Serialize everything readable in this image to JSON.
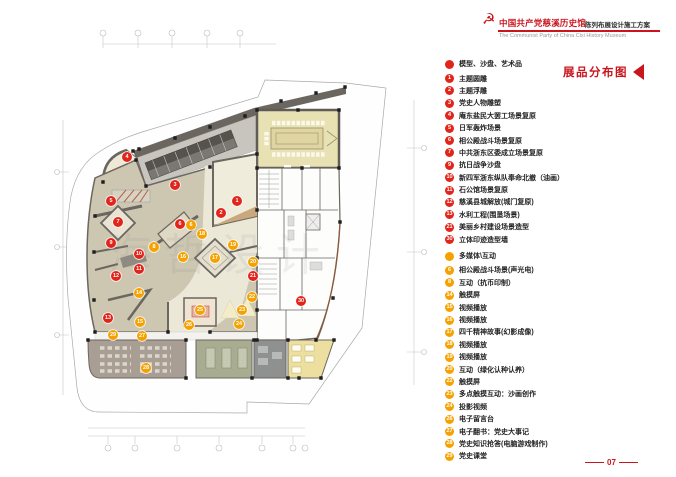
{
  "header": {
    "emblem_icon": "party-emblem",
    "title": "中国共产党慈溪历史馆",
    "subtitle": "陈列布展设计施工方案",
    "title_en": "The Communist Party of China Cixi  History Museum",
    "accent_color": "#c9161d"
  },
  "legend": {
    "title": "展品分布图",
    "sections": [
      {
        "id": "models",
        "color": "#e2251b",
        "header": "模型、沙盘、艺术品",
        "items": [
          {
            "num": "1",
            "label": "主题圆雕"
          },
          {
            "num": "2",
            "label": "主题浮雕"
          },
          {
            "num": "3",
            "label": "党史人物雕塑"
          },
          {
            "num": "4",
            "label": "庵东盐民大罢工场景复原"
          },
          {
            "num": "5",
            "label": "日军轰炸场景"
          },
          {
            "num": "6",
            "label": "相公殿战斗场景复原"
          },
          {
            "num": "7",
            "label": "中共浙东区委成立场景复原"
          },
          {
            "num": "9",
            "label": "抗日战争沙盘"
          },
          {
            "num": "10",
            "label": "新四军浙东纵队奉命北撤（油画）"
          },
          {
            "num": "11",
            "label": "石公馆场景复原"
          },
          {
            "num": "12",
            "label": "慈溪县城解放(城门复原)"
          },
          {
            "num": "13",
            "label": "水利工程(围垦场景)"
          },
          {
            "num": "21",
            "label": "美丽乡村建设场景造型"
          },
          {
            "num": "30",
            "label": "立体印迹造型墙"
          }
        ]
      },
      {
        "id": "multimedia",
        "color": "#f5a200",
        "header": "多媒体\\互动",
        "items": [
          {
            "num": "6",
            "label": "相公殿战斗场景(声光电)"
          },
          {
            "num": "8",
            "label": "互动（抗币印制）"
          },
          {
            "num": "14",
            "label": "触摸屏"
          },
          {
            "num": "15",
            "label": "视频播放"
          },
          {
            "num": "16",
            "label": "视频播放"
          },
          {
            "num": "17",
            "label": "四千精神故事(幻影成像)"
          },
          {
            "num": "18",
            "label": "视频播放"
          },
          {
            "num": "19",
            "label": "视频播放"
          },
          {
            "num": "20",
            "label": "互动（绿化认种认养）"
          },
          {
            "num": "22",
            "label": "触摸屏"
          },
          {
            "num": "23",
            "label": "多点触摸互动：沙画创作"
          },
          {
            "num": "24",
            "label": "投影视频"
          },
          {
            "num": "26",
            "label": "电子留言台"
          },
          {
            "num": "27",
            "label": "电子翻书：党史大事记"
          },
          {
            "num": "28",
            "label": "党史知识抢答(电脑游戏制作)"
          },
          {
            "num": "29",
            "label": "党史课堂"
          }
        ]
      }
    ]
  },
  "page_number": "07",
  "plan": {
    "watermark": "海哲设计",
    "colors": {
      "marker_red": "#e2251b",
      "marker_orange": "#f5a200",
      "wall_dark": "#6b6660",
      "hall_tan": "#cdc7b1",
      "hall_cream": "#ebe8d8",
      "conference_beige": "#e8e1b3",
      "room_green": "#a8ad92",
      "room_gray": "#8f9090",
      "room_yellow": "#ecdf9f",
      "room_taupe": "#a99e93"
    },
    "markers": [
      {
        "num": "1",
        "kind": "red",
        "x": 237,
        "y": 201
      },
      {
        "num": "2",
        "kind": "red",
        "x": 221,
        "y": 213
      },
      {
        "num": "3",
        "kind": "red",
        "x": 175,
        "y": 185
      },
      {
        "num": "4",
        "kind": "red",
        "x": 127,
        "y": 157
      },
      {
        "num": "5",
        "kind": "red",
        "x": 111,
        "y": 201
      },
      {
        "num": "6",
        "kind": "red",
        "x": 180,
        "y": 224
      },
      {
        "num": "7",
        "kind": "red",
        "x": 118,
        "y": 222
      },
      {
        "num": "9",
        "kind": "red",
        "x": 111,
        "y": 243
      },
      {
        "num": "10",
        "kind": "red",
        "x": 139,
        "y": 254
      },
      {
        "num": "11",
        "kind": "red",
        "x": 139,
        "y": 269
      },
      {
        "num": "12",
        "kind": "red",
        "x": 116,
        "y": 276
      },
      {
        "num": "13",
        "kind": "red",
        "x": 108,
        "y": 318
      },
      {
        "num": "21",
        "kind": "red",
        "x": 253,
        "y": 276
      },
      {
        "num": "30",
        "kind": "red",
        "x": 301,
        "y": 301
      },
      {
        "num": "6",
        "kind": "orange",
        "x": 191,
        "y": 225
      },
      {
        "num": "8",
        "kind": "orange",
        "x": 154,
        "y": 247
      },
      {
        "num": "14",
        "kind": "orange",
        "x": 139,
        "y": 293
      },
      {
        "num": "15",
        "kind": "orange",
        "x": 140,
        "y": 322
      },
      {
        "num": "16",
        "kind": "orange",
        "x": 183,
        "y": 257
      },
      {
        "num": "17",
        "kind": "orange",
        "x": 215,
        "y": 258
      },
      {
        "num": "18",
        "kind": "orange",
        "x": 202,
        "y": 234
      },
      {
        "num": "19",
        "kind": "orange",
        "x": 233,
        "y": 245
      },
      {
        "num": "20",
        "kind": "orange",
        "x": 253,
        "y": 262
      },
      {
        "num": "22",
        "kind": "orange",
        "x": 252,
        "y": 297
      },
      {
        "num": "23",
        "kind": "orange",
        "x": 242,
        "y": 310
      },
      {
        "num": "24",
        "kind": "orange",
        "x": 239,
        "y": 324
      },
      {
        "num": "25",
        "kind": "orange",
        "x": 200,
        "y": 310
      },
      {
        "num": "26",
        "kind": "orange",
        "x": 189,
        "y": 325
      },
      {
        "num": "27",
        "kind": "orange",
        "x": 142,
        "y": 336
      },
      {
        "num": "28",
        "kind": "orange",
        "x": 146,
        "y": 368
      },
      {
        "num": "29",
        "kind": "orange",
        "x": 113,
        "y": 335
      }
    ]
  }
}
